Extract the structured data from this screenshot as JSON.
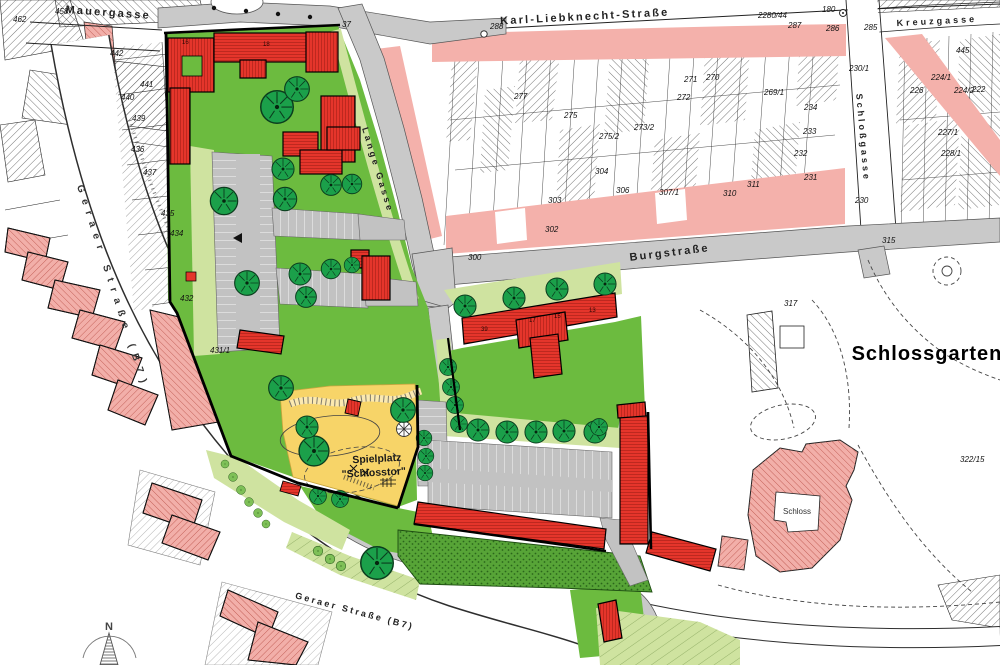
{
  "map": {
    "streets": {
      "mauergasse": "Mauergasse",
      "karl_liebknecht": "Karl-Liebknecht-Straße",
      "kreuzgasse": "Kreuzgasse",
      "lange_gasse": "Lange Gasse",
      "burgstrasse": "Burgstraße",
      "schlossgasse": "Schloßgasse",
      "geraer_left": "Geraer Straße (B7)",
      "geraer_bottom": "Geraer Straße (B7)"
    },
    "areas": {
      "schlossgarten": "Schlossgarten",
      "schloss": "Schloss",
      "spielplatz_line1": "Spielplatz",
      "spielplatz_line2": "\"Schlosstor\""
    },
    "compass": {
      "north": "N"
    },
    "colors": {
      "new_building_red": "#e5352b",
      "existing_pink": "#f2afa9",
      "lawn_green": "#6cbb3f",
      "strip_green": "#cfe3a0",
      "playground_yellow": "#f7d468",
      "street_gray": "#c9c9c9"
    },
    "parcels": [
      {
        "n": "462"
      },
      {
        "n": "458"
      },
      {
        "n": "442"
      },
      {
        "n": "441"
      },
      {
        "n": "440"
      },
      {
        "n": "439"
      },
      {
        "n": "436"
      },
      {
        "n": "437"
      },
      {
        "n": "435"
      },
      {
        "n": "434"
      },
      {
        "n": "432"
      },
      {
        "n": "431/1"
      },
      {
        "n": "37"
      },
      {
        "n": "288"
      },
      {
        "n": "277"
      },
      {
        "n": "275"
      },
      {
        "n": "275/2"
      },
      {
        "n": "273/2"
      },
      {
        "n": "272"
      },
      {
        "n": "271"
      },
      {
        "n": "270"
      },
      {
        "n": "269/1"
      },
      {
        "n": "234"
      },
      {
        "n": "233"
      },
      {
        "n": "232"
      },
      {
        "n": "231"
      },
      {
        "n": "230"
      },
      {
        "n": "230/1"
      },
      {
        "n": "285"
      },
      {
        "n": "226"
      },
      {
        "n": "224/1"
      },
      {
        "n": "224/2"
      },
      {
        "n": "222"
      },
      {
        "n": "227/1"
      },
      {
        "n": "228/1"
      },
      {
        "n": "315"
      },
      {
        "n": "317"
      },
      {
        "n": "322/15"
      },
      {
        "n": "300"
      },
      {
        "n": "303"
      },
      {
        "n": "302"
      },
      {
        "n": "304"
      },
      {
        "n": "306"
      },
      {
        "n": "307/1"
      },
      {
        "n": "310"
      },
      {
        "n": "311"
      },
      {
        "n": "2280/44"
      },
      {
        "n": "180"
      },
      {
        "n": "287"
      },
      {
        "n": "286"
      },
      {
        "n": "445"
      }
    ],
    "building_numbers": [
      {
        "n": "16"
      },
      {
        "n": "18"
      },
      {
        "n": "39"
      },
      {
        "n": "17"
      },
      {
        "n": "15"
      },
      {
        "n": "13"
      }
    ]
  }
}
